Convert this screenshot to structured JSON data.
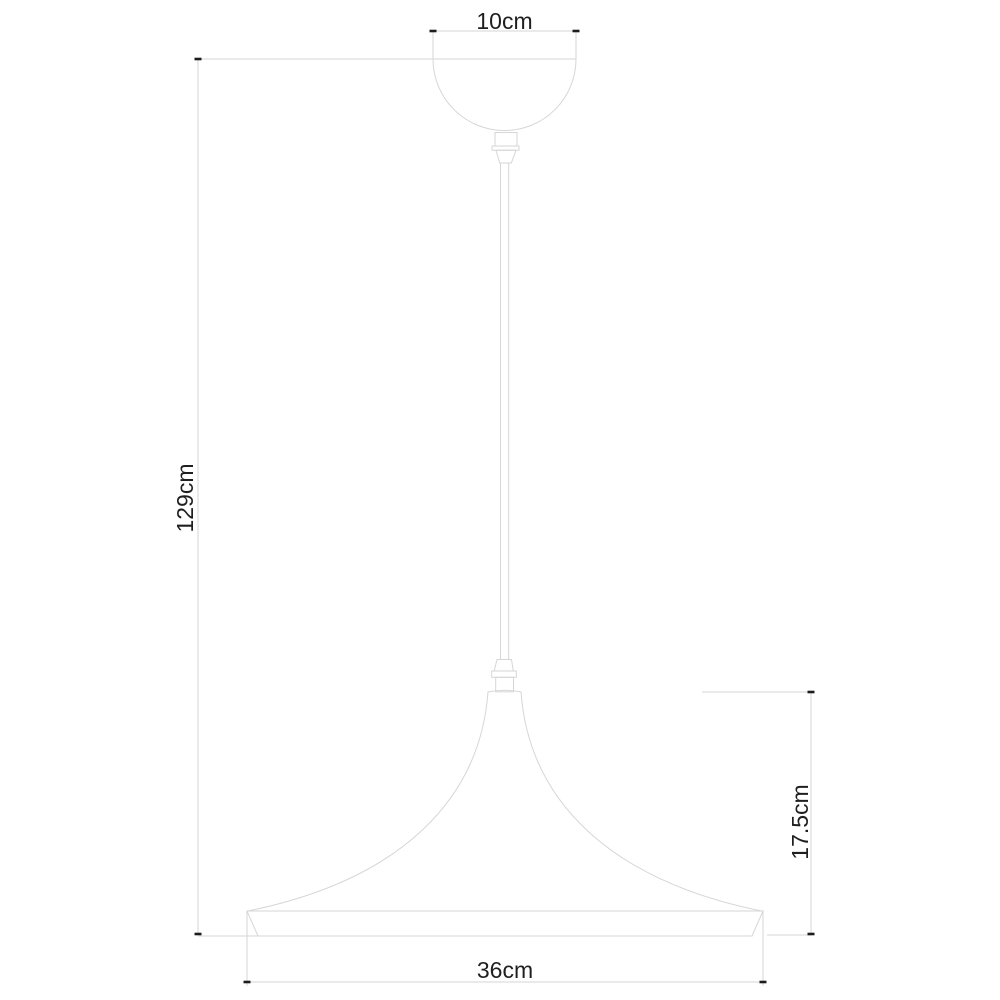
{
  "drawing": {
    "subject": "pendant-lamp-technical-dimension-drawing",
    "dimensions": {
      "canopy_width": "10cm",
      "overall_height": "129cm",
      "shade_height": "17.5cm",
      "shade_diameter": "36cm"
    },
    "colors": {
      "background": "#ffffff",
      "outline": "#d6d6d6",
      "tick": "#1c1c1c",
      "label_text": "#1f1f1f"
    }
  }
}
